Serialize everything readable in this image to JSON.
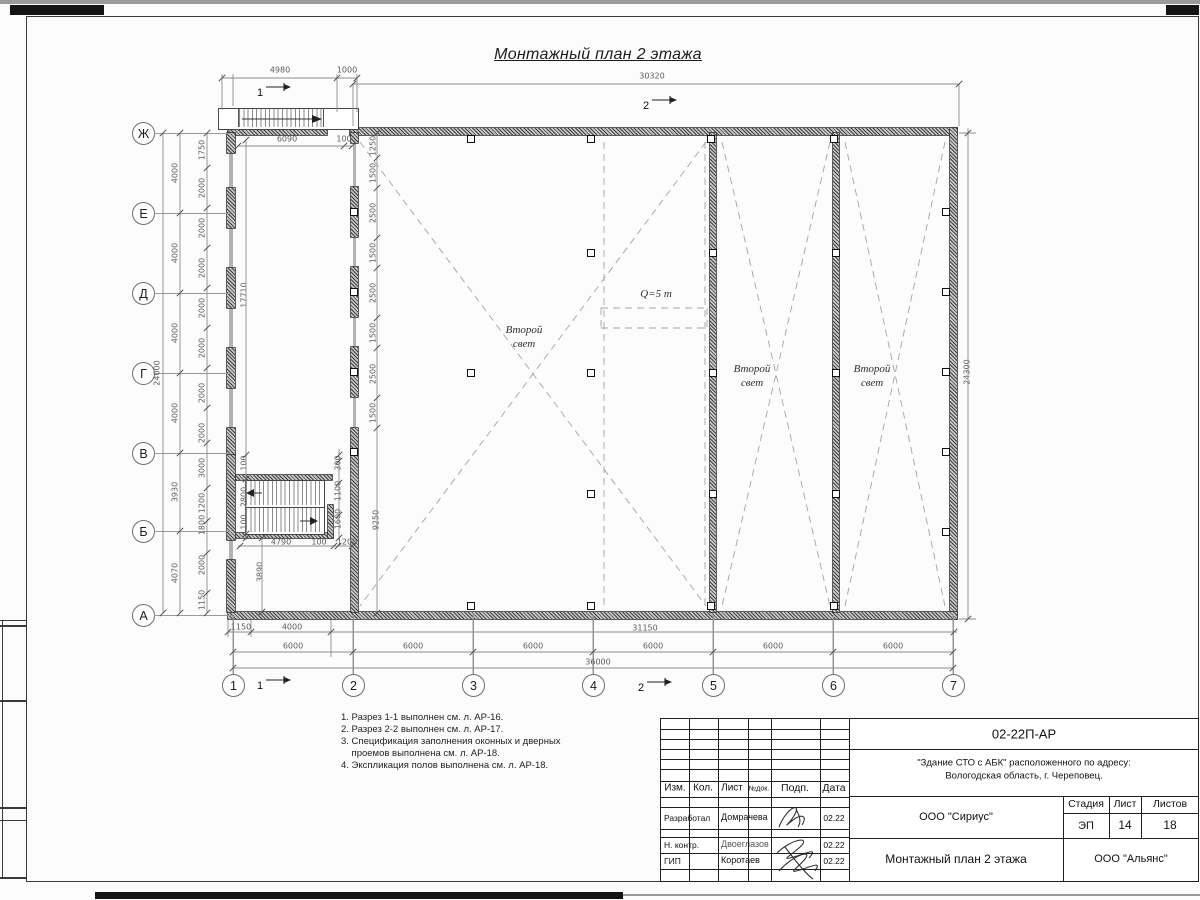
{
  "title": "Монтажный план 2 этажа",
  "plan": {
    "axes_left": [
      {
        "label": "Ж",
        "y": 133
      },
      {
        "label": "Е",
        "y": 213
      },
      {
        "label": "Д",
        "y": 293
      },
      {
        "label": "Г",
        "y": 373
      },
      {
        "label": "В",
        "y": 453
      },
      {
        "label": "Б",
        "y": 531
      },
      {
        "label": "А",
        "y": 615
      }
    ],
    "axes_bottom": [
      {
        "label": "1",
        "x": 233
      },
      {
        "label": "2",
        "x": 353
      },
      {
        "label": "3",
        "x": 473
      },
      {
        "label": "4",
        "x": 593
      },
      {
        "label": "5",
        "x": 713
      },
      {
        "label": "6",
        "x": 833
      },
      {
        "label": "7",
        "x": 953
      }
    ],
    "section_marks": [
      {
        "x": 260,
        "y": 93,
        "t": "1"
      },
      {
        "x": 646,
        "y": 106,
        "t": "2"
      },
      {
        "x": 260,
        "y": 686,
        "t": "1"
      },
      {
        "x": 641,
        "y": 688,
        "t": "2"
      }
    ],
    "room_labels": [
      {
        "x": 524,
        "y": 323,
        "lines": [
          "Второй",
          "свет"
        ]
      },
      {
        "x": 752,
        "y": 362,
        "lines": [
          "Второй",
          "свет"
        ]
      },
      {
        "x": 872,
        "y": 362,
        "lines": [
          "Второй",
          "свет"
        ]
      }
    ],
    "crane_label": {
      "x": 656,
      "y": 294,
      "text": "Q=5 т"
    },
    "dims": [
      {
        "t": "4980",
        "x": 280,
        "y": 70
      },
      {
        "t": "1000",
        "x": 347,
        "y": 70
      },
      {
        "t": "30320",
        "x": 652,
        "y": 76
      },
      {
        "t": "6090",
        "x": 287,
        "y": 139
      },
      {
        "t": "100",
        "x": 344,
        "y": 139
      },
      {
        "t": "24000",
        "x": 157,
        "y": 373,
        "r": 1
      },
      {
        "t": "4000",
        "x": 175,
        "y": 173,
        "r": 1
      },
      {
        "t": "4000",
        "x": 175,
        "y": 253,
        "r": 1
      },
      {
        "t": "4000",
        "x": 175,
        "y": 333,
        "r": 1
      },
      {
        "t": "4000",
        "x": 175,
        "y": 413,
        "r": 1
      },
      {
        "t": "3930",
        "x": 175,
        "y": 492,
        "r": 1
      },
      {
        "t": "4070",
        "x": 175,
        "y": 573,
        "r": 1
      },
      {
        "t": "1750",
        "x": 202,
        "y": 150,
        "r": 1
      },
      {
        "t": "2000",
        "x": 202,
        "y": 188,
        "r": 1
      },
      {
        "t": "2000",
        "x": 202,
        "y": 228,
        "r": 1
      },
      {
        "t": "2000",
        "x": 202,
        "y": 268,
        "r": 1
      },
      {
        "t": "2000",
        "x": 202,
        "y": 308,
        "r": 1
      },
      {
        "t": "2000",
        "x": 202,
        "y": 348,
        "r": 1
      },
      {
        "t": "2000",
        "x": 202,
        "y": 393,
        "r": 1
      },
      {
        "t": "2000",
        "x": 202,
        "y": 433,
        "r": 1
      },
      {
        "t": "3000",
        "x": 202,
        "y": 468,
        "r": 1
      },
      {
        "t": "1200",
        "x": 202,
        "y": 503,
        "r": 1
      },
      {
        "t": "1800",
        "x": 202,
        "y": 525,
        "r": 1
      },
      {
        "t": "2000",
        "x": 202,
        "y": 565,
        "r": 1
      },
      {
        "t": "1150",
        "x": 202,
        "y": 600,
        "r": 1
      },
      {
        "t": "17710",
        "x": 244,
        "y": 295,
        "r": 1
      },
      {
        "t": "100",
        "x": 244,
        "y": 463,
        "r": 1
      },
      {
        "t": "2800",
        "x": 244,
        "y": 497,
        "r": 1
      },
      {
        "t": "100",
        "x": 244,
        "y": 522,
        "r": 1
      },
      {
        "t": "3890",
        "x": 260,
        "y": 572,
        "r": 1
      },
      {
        "t": "1250",
        "x": 373,
        "y": 146,
        "r": 1
      },
      {
        "t": "1500",
        "x": 373,
        "y": 173,
        "r": 1
      },
      {
        "t": "2500",
        "x": 373,
        "y": 213,
        "r": 1
      },
      {
        "t": "1500",
        "x": 373,
        "y": 253,
        "r": 1
      },
      {
        "t": "2500",
        "x": 373,
        "y": 293,
        "r": 1
      },
      {
        "t": "1500",
        "x": 373,
        "y": 333,
        "r": 1
      },
      {
        "t": "2500",
        "x": 373,
        "y": 374,
        "r": 1
      },
      {
        "t": "1500",
        "x": 373,
        "y": 413,
        "r": 1
      },
      {
        "t": "9250",
        "x": 376,
        "y": 520,
        "r": 1
      },
      {
        "t": "300",
        "x": 338,
        "y": 463,
        "r": 1
      },
      {
        "t": "1100",
        "x": 338,
        "y": 491,
        "r": 1
      },
      {
        "t": "1600",
        "x": 338,
        "y": 519,
        "r": 1
      },
      {
        "t": "4790",
        "x": 281,
        "y": 542
      },
      {
        "t": "100",
        "x": 319,
        "y": 542
      },
      {
        "t": "1200",
        "x": 347,
        "y": 542
      },
      {
        "t": "24300",
        "x": 967,
        "y": 372,
        "r": 1
      },
      {
        "t": "1150",
        "x": 241,
        "y": 627
      },
      {
        "t": "4000",
        "x": 292,
        "y": 627
      },
      {
        "t": "31150",
        "x": 645,
        "y": 628
      },
      {
        "t": "6000",
        "x": 293,
        "y": 646
      },
      {
        "t": "6000",
        "x": 413,
        "y": 646
      },
      {
        "t": "6000",
        "x": 533,
        "y": 646
      },
      {
        "t": "6000",
        "x": 653,
        "y": 646
      },
      {
        "t": "6000",
        "x": 773,
        "y": 646
      },
      {
        "t": "6000",
        "x": 893,
        "y": 646
      },
      {
        "t": "36000",
        "x": 598,
        "y": 662
      }
    ]
  },
  "notes": [
    "1. Разрез 1-1 выполнен см. л. АР-16.",
    "2. Разрез 2-2 выполнен см. л. АР-17.",
    "3. Спецификация заполнения оконных и дверных",
    "    проемов выполнена см. л. АР-18.",
    "4. Экспликация полов выполнена см. л. АР-18."
  ],
  "titleblock": {
    "doc_number": "02-22П-АР",
    "project_line1": "\"Здание СТО с АБК\" расположенного по адресу:",
    "project_line2": "Вологодская область, г. Череповец.",
    "org1": "ООО \"Сириус\"",
    "sheet_title": "Монтажный план 2 этажа",
    "org2": "ООО \"Альянс\"",
    "cols": [
      "Изм.",
      "Кол.",
      "Лист",
      "№док.",
      "Подп.",
      "Дата"
    ],
    "stage_headers": [
      "Стадия",
      "Лист",
      "Листов"
    ],
    "stage_values": [
      "ЭП",
      "14",
      "18"
    ],
    "rows": [
      {
        "role": "Разработал",
        "name": "Домрачева",
        "date": "02.22"
      },
      {
        "role": "Н. контр.",
        "name": "Двоеглазов",
        "date": "02.22"
      },
      {
        "role": "ГИП",
        "name": "Коротаев",
        "date": "02.22"
      }
    ]
  }
}
